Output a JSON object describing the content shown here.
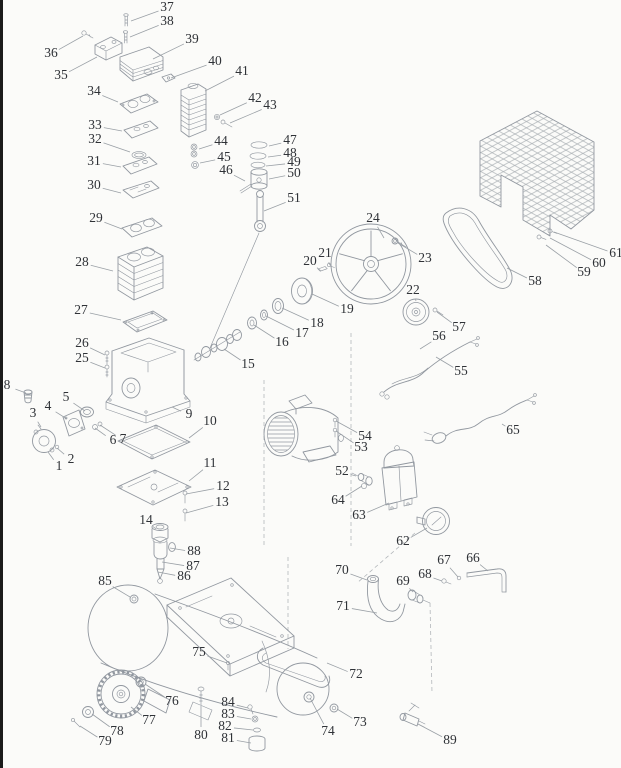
{
  "diagram": {
    "kind": "exploded-parts-diagram",
    "colors": {
      "background": "#fbfbf9",
      "line_art": "#9298a0",
      "label_text": "#2f3237",
      "leader_line": "#9aa0a6",
      "left_border": "#1b1b1b"
    },
    "labels": [
      {
        "n": "1",
        "x": 59,
        "y": 467,
        "tx": 48,
        "ty": 452
      },
      {
        "n": "2",
        "x": 71,
        "y": 460,
        "tx": 57,
        "ty": 448
      },
      {
        "n": "3",
        "x": 33,
        "y": 414,
        "tx": 41,
        "ty": 427
      },
      {
        "n": "4",
        "x": 48,
        "y": 407,
        "tx": 67,
        "ty": 419
      },
      {
        "n": "5",
        "x": 66,
        "y": 398,
        "tx": 85,
        "ty": 411
      },
      {
        "n": "6",
        "x": 113,
        "y": 441,
        "tx": 95,
        "ty": 428
      },
      {
        "n": "7",
        "x": 123,
        "y": 440,
        "tx": 100,
        "ty": 425
      },
      {
        "n": "8",
        "x": 7,
        "y": 386,
        "tx": 26,
        "ty": 393
      },
      {
        "n": "9",
        "x": 189,
        "y": 415,
        "tx": 172,
        "ty": 407
      },
      {
        "n": "10",
        "x": 210,
        "y": 422,
        "tx": 189,
        "ty": 438
      },
      {
        "n": "11",
        "x": 210,
        "y": 464,
        "tx": 189,
        "ty": 481
      },
      {
        "n": "12",
        "x": 223,
        "y": 487,
        "tx": 186,
        "ty": 494
      },
      {
        "n": "13",
        "x": 222,
        "y": 503,
        "tx": 186,
        "ty": 513
      },
      {
        "n": "14",
        "x": 146,
        "y": 521,
        "tx": 156,
        "ty": 529
      },
      {
        "n": "15",
        "x": 248,
        "y": 365,
        "tx": 224,
        "ty": 349
      },
      {
        "n": "16",
        "x": 282,
        "y": 343,
        "tx": 254,
        "ty": 325
      },
      {
        "n": "17",
        "x": 302,
        "y": 334,
        "tx": 266,
        "ty": 316
      },
      {
        "n": "18",
        "x": 317,
        "y": 324,
        "tx": 282,
        "ty": 308
      },
      {
        "n": "19",
        "x": 347,
        "y": 310,
        "tx": 312,
        "ty": 294
      },
      {
        "n": "20",
        "x": 310,
        "y": 262,
        "tx": 321,
        "ty": 271
      },
      {
        "n": "21",
        "x": 325,
        "y": 254,
        "tx": 330,
        "ty": 265
      },
      {
        "n": "22",
        "x": 413,
        "y": 291,
        "tx": 416,
        "ty": 301
      },
      {
        "n": "23",
        "x": 425,
        "y": 259,
        "tx": 398,
        "ty": 243
      },
      {
        "n": "24",
        "x": 373,
        "y": 219,
        "tx": 384,
        "ty": 238
      },
      {
        "n": "25",
        "x": 82,
        "y": 359,
        "tx": 105,
        "ty": 368
      },
      {
        "n": "26",
        "x": 82,
        "y": 344,
        "tx": 105,
        "ty": 355
      },
      {
        "n": "27",
        "x": 81,
        "y": 311,
        "tx": 121,
        "ty": 320
      },
      {
        "n": "28",
        "x": 82,
        "y": 263,
        "tx": 113,
        "ty": 271
      },
      {
        "n": "29",
        "x": 96,
        "y": 219,
        "tx": 122,
        "ty": 229
      },
      {
        "n": "30",
        "x": 94,
        "y": 186,
        "tx": 121,
        "ty": 193
      },
      {
        "n": "31",
        "x": 94,
        "y": 162,
        "tx": 121,
        "ty": 167
      },
      {
        "n": "32",
        "x": 95,
        "y": 140,
        "tx": 130,
        "ty": 152
      },
      {
        "n": "33",
        "x": 95,
        "y": 126,
        "tx": 122,
        "ty": 131
      },
      {
        "n": "34",
        "x": 94,
        "y": 92,
        "tx": 118,
        "ty": 102
      },
      {
        "n": "35",
        "x": 61,
        "y": 76,
        "tx": 97,
        "ty": 57
      },
      {
        "n": "36",
        "x": 51,
        "y": 54,
        "tx": 83,
        "ty": 36
      },
      {
        "n": "37",
        "x": 167,
        "y": 8,
        "tx": 131,
        "ty": 21
      },
      {
        "n": "38",
        "x": 167,
        "y": 22,
        "tx": 130,
        "ty": 37
      },
      {
        "n": "39",
        "x": 192,
        "y": 40,
        "tx": 153,
        "ty": 59
      },
      {
        "n": "40",
        "x": 215,
        "y": 62,
        "tx": 171,
        "ty": 78
      },
      {
        "n": "41",
        "x": 242,
        "y": 72,
        "tx": 205,
        "ty": 91
      },
      {
        "n": "42",
        "x": 255,
        "y": 99,
        "tx": 220,
        "ty": 115
      },
      {
        "n": "43",
        "x": 270,
        "y": 106,
        "tx": 230,
        "ty": 123
      },
      {
        "n": "44",
        "x": 221,
        "y": 142,
        "tx": 199,
        "ty": 149
      },
      {
        "n": "45",
        "x": 224,
        "y": 158,
        "tx": 200,
        "ty": 163
      },
      {
        "n": "46",
        "x": 226,
        "y": 171,
        "tx": 245,
        "ty": 181
      },
      {
        "n": "47",
        "x": 290,
        "y": 141,
        "tx": 269,
        "ty": 146
      },
      {
        "n": "48",
        "x": 290,
        "y": 154,
        "tx": 268,
        "ty": 157
      },
      {
        "n": "49",
        "x": 294,
        "y": 163,
        "tx": 266,
        "ty": 166
      },
      {
        "n": "50",
        "x": 294,
        "y": 174,
        "tx": 269,
        "ty": 179
      },
      {
        "n": "51",
        "x": 294,
        "y": 199,
        "tx": 264,
        "ty": 211
      },
      {
        "n": "52",
        "x": 342,
        "y": 472,
        "tx": 356,
        "ty": 476
      },
      {
        "n": "53",
        "x": 361,
        "y": 448,
        "tx": 336,
        "ty": 431
      },
      {
        "n": "54",
        "x": 365,
        "y": 437,
        "tx": 336,
        "ty": 421
      },
      {
        "n": "55",
        "x": 461,
        "y": 372,
        "tx": 436,
        "ty": 357
      },
      {
        "n": "56",
        "x": 439,
        "y": 337,
        "tx": 420,
        "ty": 349
      },
      {
        "n": "57",
        "x": 459,
        "y": 328,
        "tx": 437,
        "ty": 312
      },
      {
        "n": "58",
        "x": 535,
        "y": 282,
        "tx": 507,
        "ty": 268
      },
      {
        "n": "59",
        "x": 584,
        "y": 273,
        "tx": 546,
        "ty": 245
      },
      {
        "n": "60",
        "x": 599,
        "y": 264,
        "tx": 550,
        "ty": 238
      },
      {
        "n": "61",
        "x": 616,
        "y": 254,
        "tx": 554,
        "ty": 232
      },
      {
        "n": "62",
        "x": 403,
        "y": 542,
        "tx": 427,
        "ty": 528
      },
      {
        "n": "63",
        "x": 359,
        "y": 516,
        "tx": 389,
        "ty": 503
      },
      {
        "n": "64",
        "x": 338,
        "y": 501,
        "tx": 362,
        "ty": 486
      },
      {
        "n": "65",
        "x": 513,
        "y": 431,
        "tx": 502,
        "ty": 424
      },
      {
        "n": "66",
        "x": 473,
        "y": 559,
        "tx": 488,
        "ty": 571
      },
      {
        "n": "67",
        "x": 444,
        "y": 561,
        "tx": 458,
        "ty": 577
      },
      {
        "n": "68",
        "x": 425,
        "y": 575,
        "tx": 442,
        "ty": 581
      },
      {
        "n": "69",
        "x": 403,
        "y": 582,
        "tx": 413,
        "ty": 592
      },
      {
        "n": "70",
        "x": 342,
        "y": 571,
        "tx": 367,
        "ty": 580
      },
      {
        "n": "71",
        "x": 343,
        "y": 607,
        "tx": 377,
        "ty": 613
      },
      {
        "n": "72",
        "x": 356,
        "y": 675,
        "tx": 327,
        "ty": 663
      },
      {
        "n": "73",
        "x": 360,
        "y": 723,
        "tx": 337,
        "ty": 709
      },
      {
        "n": "74",
        "x": 328,
        "y": 732,
        "tx": 310,
        "ty": 698
      },
      {
        "n": "75",
        "x": 199,
        "y": 653,
        "tx": 227,
        "ty": 663
      },
      {
        "n": "76",
        "x": 172,
        "y": 702,
        "tx": 145,
        "ty": 684
      },
      {
        "n": "77",
        "x": 149,
        "y": 721,
        "tx": 131,
        "ty": 707
      },
      {
        "n": "78",
        "x": 117,
        "y": 732,
        "tx": 92,
        "ty": 714
      },
      {
        "n": "79",
        "x": 105,
        "y": 742,
        "tx": 80,
        "ty": 726
      },
      {
        "n": "80",
        "x": 201,
        "y": 736,
        "tx": 201,
        "ty": 706
      },
      {
        "n": "81",
        "x": 228,
        "y": 739,
        "tx": 251,
        "ty": 743
      },
      {
        "n": "82",
        "x": 225,
        "y": 727,
        "tx": 253,
        "ty": 730
      },
      {
        "n": "83",
        "x": 228,
        "y": 715,
        "tx": 251,
        "ty": 719
      },
      {
        "n": "84",
        "x": 228,
        "y": 703,
        "tx": 248,
        "ty": 708
      },
      {
        "n": "85",
        "x": 105,
        "y": 582,
        "tx": 130,
        "ty": 597
      },
      {
        "n": "86",
        "x": 184,
        "y": 577,
        "tx": 158,
        "ty": 572
      },
      {
        "n": "87",
        "x": 193,
        "y": 567,
        "tx": 162,
        "ty": 562
      },
      {
        "n": "88",
        "x": 194,
        "y": 552,
        "tx": 170,
        "ty": 548
      },
      {
        "n": "89",
        "x": 450,
        "y": 741,
        "tx": 418,
        "ty": 724
      }
    ]
  }
}
